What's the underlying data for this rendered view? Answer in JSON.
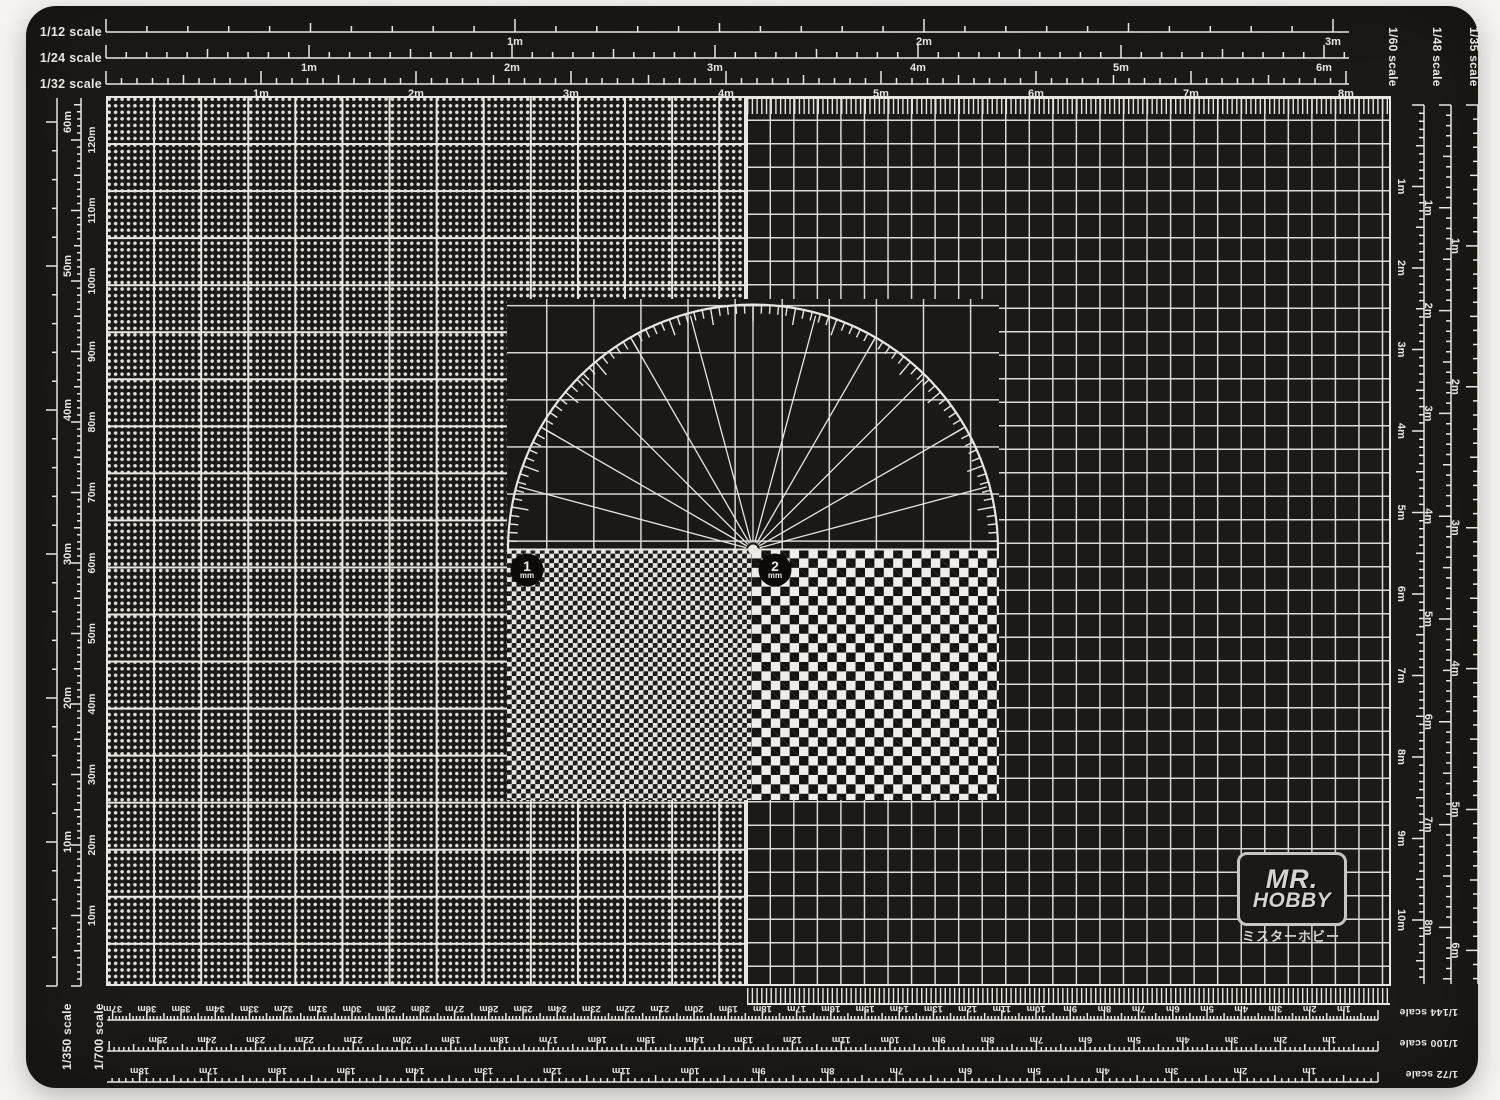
{
  "photo": {
    "background_color": "#f6f4f2"
  },
  "mat": {
    "surface_color": "#1c1916",
    "line_color": "#e9e6e1"
  },
  "rulers": {
    "top": [
      {
        "name": "1/12 scale",
        "tick_labels": [
          "1m",
          "2m",
          "3m"
        ]
      },
      {
        "name": "1/24 scale",
        "tick_labels": [
          "1m",
          "2m",
          "3m",
          "4m",
          "5m",
          "6m"
        ]
      },
      {
        "name": "1/32 scale",
        "tick_labels": [
          "1m",
          "2m",
          "3m",
          "4m",
          "5m",
          "6m",
          "7m",
          "8m"
        ]
      }
    ],
    "left": [
      {
        "name": "1/350 scale",
        "tick_labels": [
          "10m",
          "20m",
          "30m",
          "40m",
          "50m",
          "60m"
        ]
      },
      {
        "name": "1/700 scale",
        "tick_labels": [
          "10m",
          "20m",
          "30m",
          "40m",
          "50m",
          "60m",
          "70m",
          "80m",
          "90m",
          "100m",
          "110m",
          "120m"
        ]
      }
    ],
    "right": [
      {
        "name": "1/60 scale",
        "tick_labels": [
          "1m",
          "2m",
          "3m",
          "4m",
          "5m",
          "6m",
          "7m",
          "8m",
          "9m",
          "10m"
        ]
      },
      {
        "name": "1/48 scale",
        "tick_labels": [
          "1m",
          "2m",
          "3m",
          "4m",
          "5m",
          "6m",
          "7m",
          "8m"
        ]
      },
      {
        "name": "1/35 scale",
        "tick_labels": [
          "1m",
          "2m",
          "3m",
          "4m",
          "5m",
          "6m"
        ]
      }
    ],
    "bottom": [
      {
        "name": "1/144 scale",
        "tick_labels": [
          "1m",
          "2m",
          "3m",
          "4m",
          "5m",
          "6m",
          "7m",
          "8m",
          "9m",
          "10m",
          "11m",
          "12m",
          "13m",
          "14m",
          "15m",
          "16m",
          "17m",
          "18m",
          "19m",
          "20m",
          "21m",
          "22m",
          "23m",
          "24m",
          "25m",
          "26m",
          "27m",
          "28m",
          "29m",
          "30m",
          "31m",
          "32m",
          "33m",
          "34m",
          "35m",
          "36m",
          "37m"
        ]
      },
      {
        "name": "1/100 scale",
        "tick_labels": [
          "1m",
          "2m",
          "3m",
          "4m",
          "5m",
          "6m",
          "7m",
          "8m",
          "9m",
          "10m",
          "11m",
          "12m",
          "13m",
          "14m",
          "15m",
          "16m",
          "17m",
          "18m",
          "19m",
          "20m",
          "21m",
          "22m",
          "23m",
          "24m",
          "25m"
        ]
      },
      {
        "name": "1/72 scale",
        "tick_labels": [
          "1m",
          "2m",
          "3m",
          "4m",
          "5m",
          "6m",
          "7m",
          "8m",
          "9m",
          "10m",
          "11m",
          "12m",
          "13m",
          "14m",
          "15m",
          "16m",
          "17m",
          "18m"
        ]
      }
    ]
  },
  "protractor": {
    "minor_step_deg": 2,
    "major_step_deg": 10,
    "fan_step_deg": 15,
    "degree_range": [
      0,
      180
    ]
  },
  "measure_badges": [
    {
      "value": "1",
      "unit": "mm"
    },
    {
      "value": "2",
      "unit": "mm"
    }
  ],
  "logo": {
    "line1": "MR.",
    "line2": "HOBBY",
    "subtitle": "ミスターホビー"
  }
}
